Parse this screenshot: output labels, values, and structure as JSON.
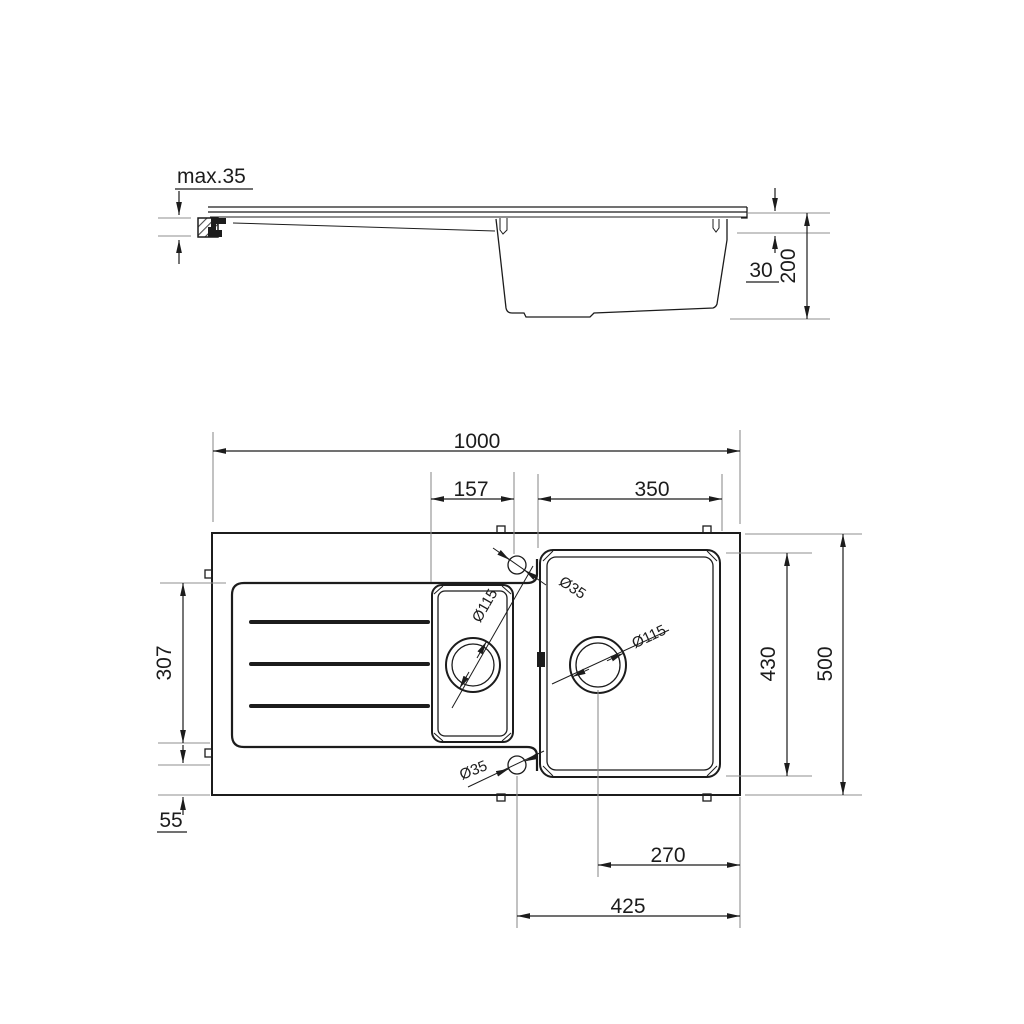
{
  "drawing": {
    "title_hint": "kitchen sink dimensional drawing",
    "colors": {
      "background": "#ffffff",
      "line": "#1c1c1c",
      "extension": "#8f8f8f"
    },
    "side_view": {
      "countertop_thickness": "max.35",
      "rim_mount_depth": "30",
      "bowl_depth": "200"
    },
    "plan_view": {
      "overall_width": "1000",
      "small_bowl_to_tap": "157",
      "main_bowl_width": "350",
      "drainer_length": "307",
      "tap_edge_offset": "55",
      "main_bowl_length": "430",
      "overall_depth": "500",
      "drain_to_edge": "270",
      "tap_to_edge": "425",
      "tap_hole_top": "Ø35",
      "tap_hole_bottom": "Ø35",
      "small_bowl_drain": "Ø115",
      "main_bowl_drain": "Ø115"
    }
  }
}
